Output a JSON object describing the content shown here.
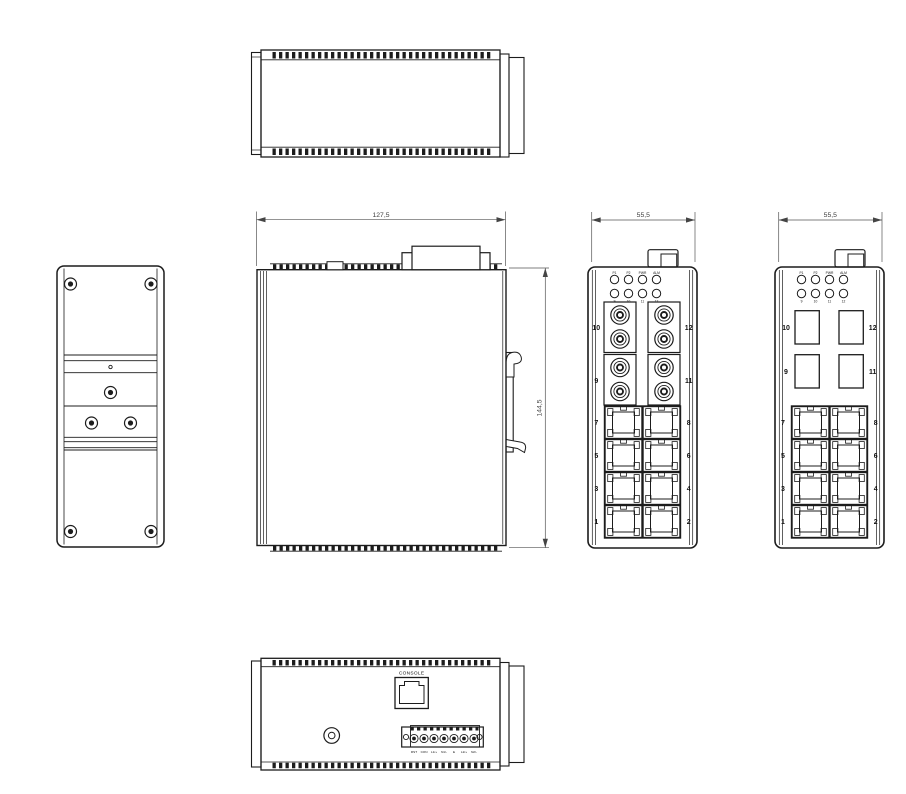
{
  "dimensions": {
    "overall_width": "127,5",
    "overall_height": "144,5",
    "front_width": "55,5"
  },
  "leds": {
    "status": [
      "P1",
      "P2",
      "PWR",
      "ALM"
    ],
    "ports": [
      "9",
      "10",
      "11",
      "12"
    ]
  },
  "fiber_ports": {
    "top_left": "10",
    "bottom_left": "9",
    "top_right": "12",
    "bottom_right": "11"
  },
  "rj45_ports": {
    "left": [
      "7",
      "5",
      "3",
      "1"
    ],
    "right": [
      "8",
      "6",
      "4",
      "2"
    ]
  },
  "bottom": {
    "console": "CONSOLE",
    "terminals": [
      "RST",
      "CON",
      "L1/+",
      "N1/-",
      "E",
      "L2/+",
      "N2/-"
    ]
  },
  "colors": {
    "line": "#1c1c1c",
    "dim_text": "#3f3f3f",
    "background": "#ffffff"
  }
}
